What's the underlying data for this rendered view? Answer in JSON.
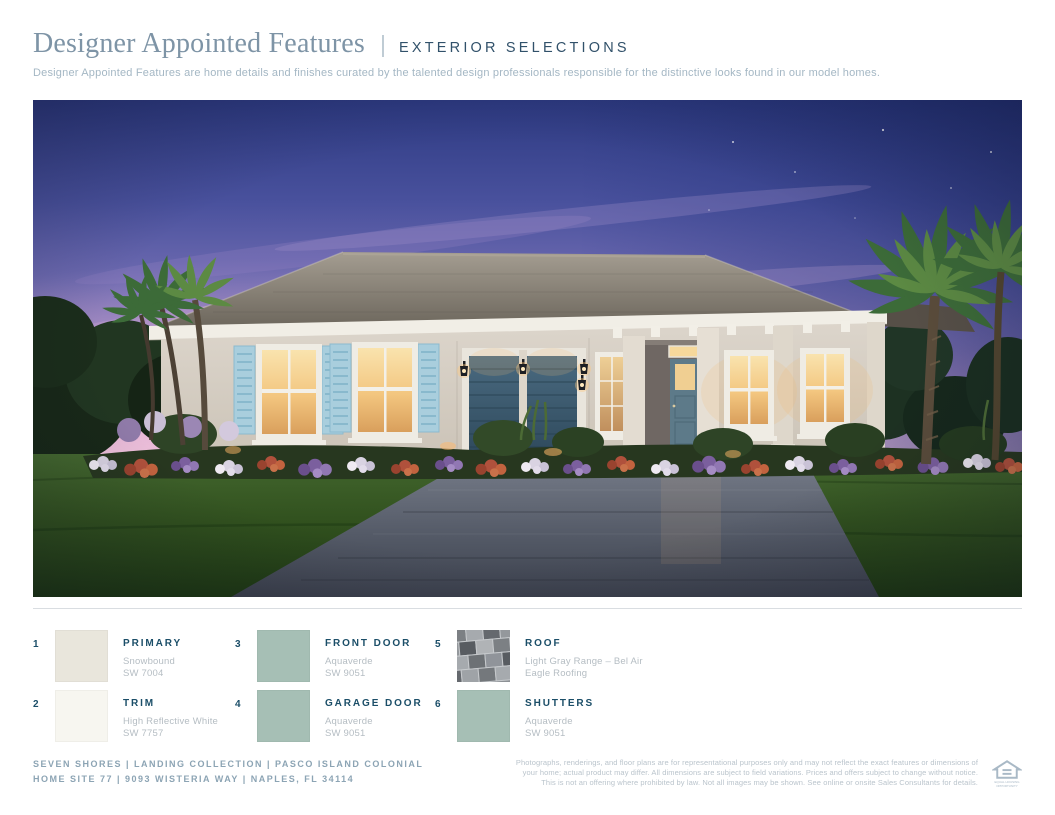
{
  "header": {
    "title": "Designer Appointed Features",
    "separator": "|",
    "tag": "EXTERIOR SELECTIONS",
    "description": "Designer Appointed Features are home details and finishes curated by the talented design professionals responsible for the distinctive looks found in our model homes."
  },
  "hero": {
    "scene": "twilight-rendering-of-single-story-home"
  },
  "selections": [
    {
      "number": "1",
      "label": "PRIMARY",
      "line1": "Snowbound",
      "line2": "SW 7004",
      "swatch": "#e9e6dc"
    },
    {
      "number": "2",
      "label": "TRIM",
      "line1": "High Reflective White",
      "line2": "SW 7757",
      "swatch": "#f7f6f0"
    },
    {
      "number": "3",
      "label": "FRONT DOOR",
      "line1": "Aquaverde",
      "line2": "SW 9051",
      "swatch": "#a6bfb5"
    },
    {
      "number": "4",
      "label": "GARAGE DOOR",
      "line1": "Aquaverde",
      "line2": "SW 9051",
      "swatch": "#a6bfb5"
    },
    {
      "number": "5",
      "label": "ROOF",
      "line1": "Light Gray Range – Bel Air",
      "line2": "Eagle Roofing",
      "swatch": "roof-photo"
    },
    {
      "number": "6",
      "label": "SHUTTERS",
      "line1": "Aquaverde",
      "line2": "SW 9051",
      "swatch": "#a6bfb5"
    }
  ],
  "footer": {
    "line1": "SEVEN SHORES | LANDING COLLECTION  | PASCO ISLAND COLONIAL",
    "line2": "HOME SITE 77  |  9093 WISTERIA WAY |  NAPLES, FL 34114",
    "disclaimer1": "Photographs, renderings, and floor plans are for representational purposes only and may not reflect the exact features or dimensions of",
    "disclaimer2": "your home; actual product may differ. All dimensions are subject to field variations. Prices and offers subject to change without notice.",
    "disclaimer3": "This is not an offering where prohibited by law. Not all images may be shown. See online or onsite Sales Consultants for details.",
    "eho_line1": "EQUAL HOUSING",
    "eho_line2": "OPPORTUNITY"
  },
  "colors": {
    "title": "#7e94a6",
    "tag": "#31516a",
    "label_navy": "#1b4e68",
    "muted_text": "#b5bdc3",
    "footer_text": "#8ca4b4",
    "aquaverde": "#a6bfb5",
    "snowbound": "#e9e6dc",
    "high_reflective_white": "#f7f6f0"
  }
}
